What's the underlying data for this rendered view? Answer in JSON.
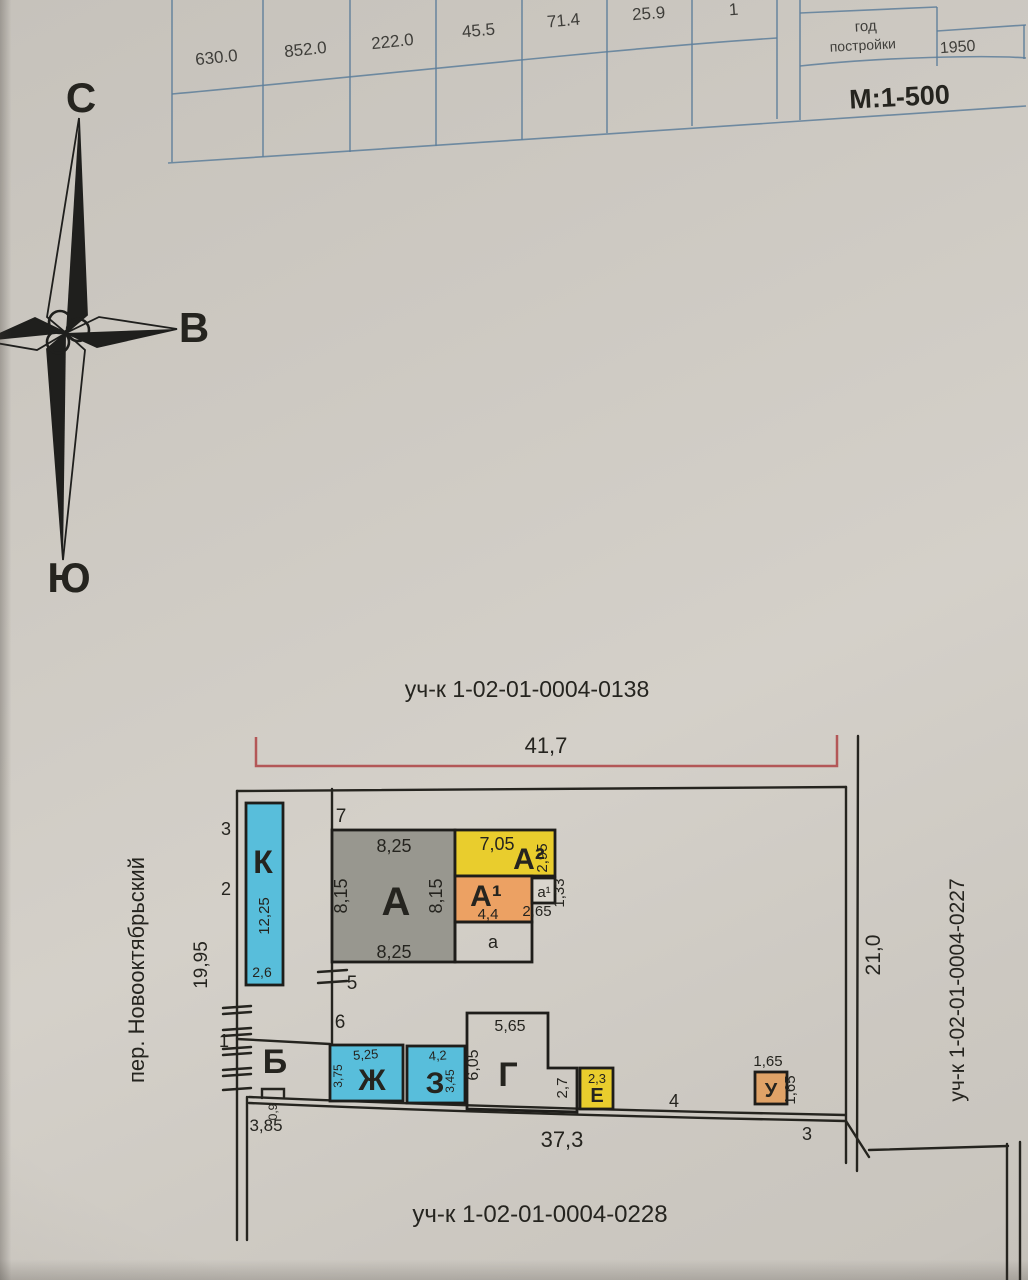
{
  "table": {
    "values": [
      "630.0",
      "852.0",
      "222.0",
      "45.5",
      "71.4",
      "25.9",
      "1"
    ],
    "year_label_line1": "год",
    "year_label_line2": "постройки",
    "year_value": "1950",
    "scale_label": "М:1-500"
  },
  "compass": {
    "north": "С",
    "east": "В",
    "south": "Ю"
  },
  "plan": {
    "parcel_top": "уч-к 1-02-01-0004-0138",
    "parcel_right": "уч-к 1-02-01-0004-0227",
    "parcel_bottom": "уч-к 1-02-01-0004-0228",
    "street": "пер. Новооктябрьский",
    "dims": {
      "top": "41,7",
      "bottom": "37,3",
      "right": "21,0",
      "left": "19,95",
      "left_bottom": "3,85",
      "notch": "0,9"
    },
    "points": {
      "p1": "1",
      "p2": "2",
      "p3": "3",
      "p3_bottom": "3",
      "p4": "4",
      "p5": "5",
      "p6": "6",
      "p7": "7"
    },
    "buildings": {
      "K": {
        "label": "К",
        "height": "12,25",
        "width": "2,6"
      },
      "A": {
        "label": "А",
        "top": "8,25",
        "left": "8,15",
        "right": "8,15",
        "bottom": "8,25"
      },
      "A2": {
        "label": "А²",
        "top": "7,05",
        "right": "2,95"
      },
      "A1": {
        "label": "А¹",
        "bottom": "4,4"
      },
      "a1": {
        "label": "а¹",
        "bottom": "2,65",
        "right": "1,33"
      },
      "a": {
        "label": "а"
      },
      "B": {
        "label": "Б"
      },
      "Zh": {
        "label": "Ж",
        "top": "5,25",
        "left": "3,75"
      },
      "Z": {
        "label": "З",
        "top": "4,2",
        "right": "3,45"
      },
      "G": {
        "label": "Г",
        "top": "5,65",
        "left": "6,05",
        "right_step": "2,7"
      },
      "E": {
        "label": "Е",
        "top": "2,3"
      },
      "U": {
        "label": "У",
        "top": "1,65",
        "right": "1,65"
      }
    }
  },
  "colors": {
    "paper": "#cfcbc4",
    "table_line": "#5d7e9a",
    "ink": "#25241f",
    "dim_red": "#b35757",
    "building_cyan": "#58bedb",
    "building_gray": "#98978f",
    "building_yellow": "#e9cd2d",
    "building_orange": "#eca163",
    "building_tan": "#dfa267",
    "label_maroon": "#6e2a1e"
  }
}
